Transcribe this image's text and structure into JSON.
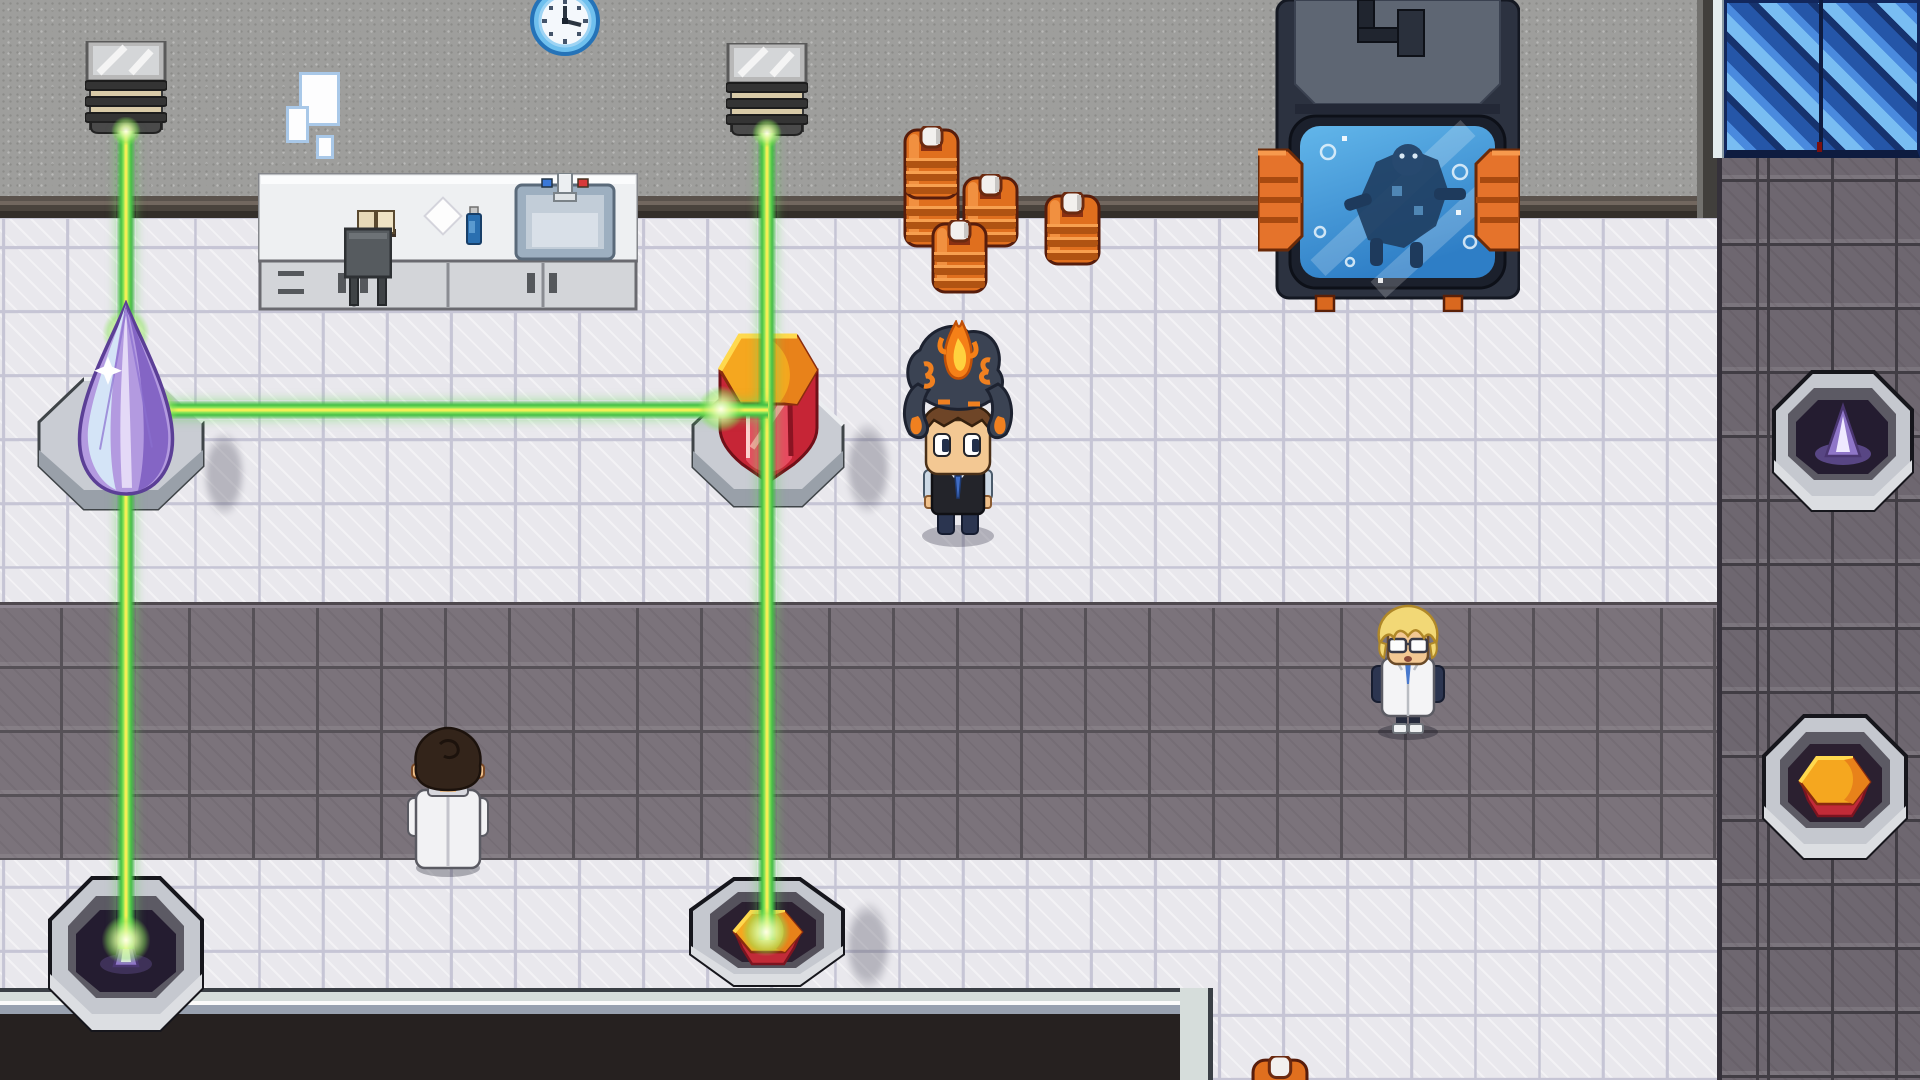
{
  "scene": {
    "kind": "top-down pixel-art laboratory / laser puzzle room",
    "width": 1920,
    "height": 1080,
    "palette": {
      "wall": "#9e9e9c",
      "tile_white": "#e9e8ed",
      "carpet": "#7b737b",
      "tile_dark": "#6e6770",
      "pit_dark": "#262120",
      "beam_green": "#46c046",
      "beam_core": "#f4ef55",
      "barrel_orange": "#e06f1e",
      "door_blue": "#4a8ade",
      "crystal_purple": "#b39ae0",
      "crystal_red": "#d8304a",
      "gem_orange": "#f5a71f",
      "pedestal_gray": "#c9ccd3"
    }
  },
  "e": {
    "wall": {
      "label": "back wall",
      "rect": {
        "x": 0,
        "y": 0,
        "w": 1920,
        "h": 198
      }
    },
    "trim": {
      "label": "wall base trim",
      "rect": {
        "x": 0,
        "y": 196,
        "w": 1717,
        "h": 22
      }
    },
    "wallEdge": {
      "label": "wall corner edge",
      "rect": {
        "x": 1697,
        "y": 0,
        "w": 22,
        "h": 218
      }
    },
    "floor": {
      "label": "white tile floor",
      "rect": {
        "x": 0,
        "y": 218,
        "w": 1920,
        "h": 862
      }
    },
    "rightTiles": {
      "label": "dark tile floor strip",
      "rect": {
        "x": 1717,
        "y": 156,
        "w": 203,
        "h": 924
      }
    },
    "carpet": {
      "label": "gray carpet band",
      "rect": {
        "x": 0,
        "y": 602,
        "w": 1717,
        "h": 258
      }
    },
    "pit": {
      "label": "lower dark area",
      "rect": {
        "x": 0,
        "y": 988,
        "w": 1213,
        "h": 92
      }
    },
    "door": {
      "label": "blue sliding door",
      "rect": {
        "x": 1713,
        "y": 0,
        "w": 207,
        "h": 158
      }
    },
    "clock": {
      "label": "wall clock",
      "rect": {
        "x": 528,
        "y": 0,
        "w": 74,
        "h": 58
      }
    },
    "poster1": {
      "rect": {
        "x": 299,
        "y": 72,
        "w": 41,
        "h": 54
      }
    },
    "poster2": {
      "rect": {
        "x": 286,
        "y": 106,
        "w": 23,
        "h": 37
      }
    },
    "poster3": {
      "rect": {
        "x": 316,
        "y": 135,
        "w": 18,
        "h": 24
      }
    },
    "emitter1": {
      "label": "laser emitter",
      "rect": {
        "x": 85,
        "y": 41,
        "w": 82,
        "h": 93
      }
    },
    "emitter2": {
      "label": "laser emitter",
      "rect": {
        "x": 726,
        "y": 43,
        "w": 82,
        "h": 93
      }
    },
    "counter": {
      "label": "lab counter with sink",
      "rect": {
        "x": 258,
        "y": 173,
        "w": 380,
        "h": 140
      }
    },
    "trolley": {
      "label": "small cart",
      "rect": {
        "x": 344,
        "y": 227,
        "w": 48,
        "h": 84
      }
    },
    "bBotBack": {
      "rect": {
        "x": 903,
        "y": 174,
        "w": 57,
        "h": 74
      }
    },
    "bTopBack": {
      "rect": {
        "x": 903,
        "y": 126,
        "w": 57,
        "h": 74
      }
    },
    "bMid": {
      "rect": {
        "x": 962,
        "y": 174,
        "w": 57,
        "h": 74
      }
    },
    "bFront": {
      "rect": {
        "x": 931,
        "y": 220,
        "w": 57,
        "h": 74
      }
    },
    "bRight": {
      "rect": {
        "x": 1044,
        "y": 192,
        "w": 57,
        "h": 74
      }
    },
    "barrelPeek": {
      "rect": {
        "x": 1251,
        "y": 1056,
        "w": 58,
        "h": 24
      }
    },
    "tank": {
      "label": "specimen tank machine",
      "rect": {
        "x": 1258,
        "y": 0,
        "w": 262,
        "h": 312
      }
    },
    "pedPurple": {
      "rect": {
        "x": 36,
        "y": 376,
        "w": 170,
        "h": 136
      }
    },
    "crystalPurple": {
      "label": "purple crystal",
      "rect": {
        "x": 70,
        "y": 300,
        "w": 112,
        "h": 198
      }
    },
    "pedRed": {
      "rect": {
        "x": 690,
        "y": 383,
        "w": 156,
        "h": 126
      }
    },
    "crystalRed": {
      "label": "red prism crystal",
      "rect": {
        "x": 718,
        "y": 332,
        "w": 101,
        "h": 153
      }
    },
    "recvBL": {
      "label": "receiver pedestal",
      "rect": {
        "x": 44,
        "y": 874,
        "w": 162,
        "h": 170
      }
    },
    "recvBC": {
      "label": "receiver pedestal",
      "rect": {
        "x": 688,
        "y": 876,
        "w": 158,
        "h": 112
      }
    },
    "recvRM": {
      "label": "receiver pedestal",
      "rect": {
        "x": 1768,
        "y": 368,
        "w": 148,
        "h": 154
      }
    },
    "recvRB": {
      "label": "receiver pedestal",
      "rect": {
        "x": 1760,
        "y": 712,
        "w": 150,
        "h": 158
      }
    },
    "beamV1": {
      "rect": {
        "x": 116,
        "y": 131,
        "w": 20,
        "h": 818
      }
    },
    "beamV2": {
      "rect": {
        "x": 757,
        "y": 133,
        "w": 20,
        "h": 807
      }
    },
    "beamH": {
      "rect": {
        "x": 140,
        "y": 400,
        "w": 628,
        "h": 20
      }
    },
    "glowTip": {
      "rect": {
        "x": 102,
        "y": 310,
        "w": 48,
        "h": 46
      }
    },
    "glowPR": {
      "rect": {
        "x": 132,
        "y": 386,
        "w": 46,
        "h": 46
      }
    },
    "glowRL": {
      "rect": {
        "x": 698,
        "y": 386,
        "w": 46,
        "h": 46
      }
    },
    "glowBC": {
      "rect": {
        "x": 742,
        "y": 908,
        "w": 48,
        "h": 48
      }
    },
    "glowBL": {
      "rect": {
        "x": 102,
        "y": 916,
        "w": 48,
        "h": 48
      }
    },
    "glowE1": {
      "rect": {
        "x": 111,
        "y": 117,
        "w": 30,
        "h": 28
      }
    },
    "glowE2": {
      "rect": {
        "x": 752,
        "y": 119,
        "w": 30,
        "h": 28
      }
    },
    "player": {
      "label": "player with flame creature on head",
      "rect": {
        "x": 898,
        "y": 320,
        "w": 120,
        "h": 232
      }
    },
    "scientist": {
      "label": "blonde scientist npc",
      "rect": {
        "x": 1366,
        "y": 604,
        "w": 84,
        "h": 136
      }
    },
    "researcher": {
      "label": "dark-haired researcher npc",
      "rect": {
        "x": 404,
        "y": 726,
        "w": 88,
        "h": 152
      }
    },
    "sh1": {
      "rect": {
        "x": 844,
        "y": 420,
        "w": 48,
        "h": 96
      }
    },
    "sh2": {
      "rect": {
        "x": 202,
        "y": 430,
        "w": 44,
        "h": 88
      }
    },
    "sh3": {
      "rect": {
        "x": 844,
        "y": 900,
        "w": 48,
        "h": 92
      }
    }
  }
}
